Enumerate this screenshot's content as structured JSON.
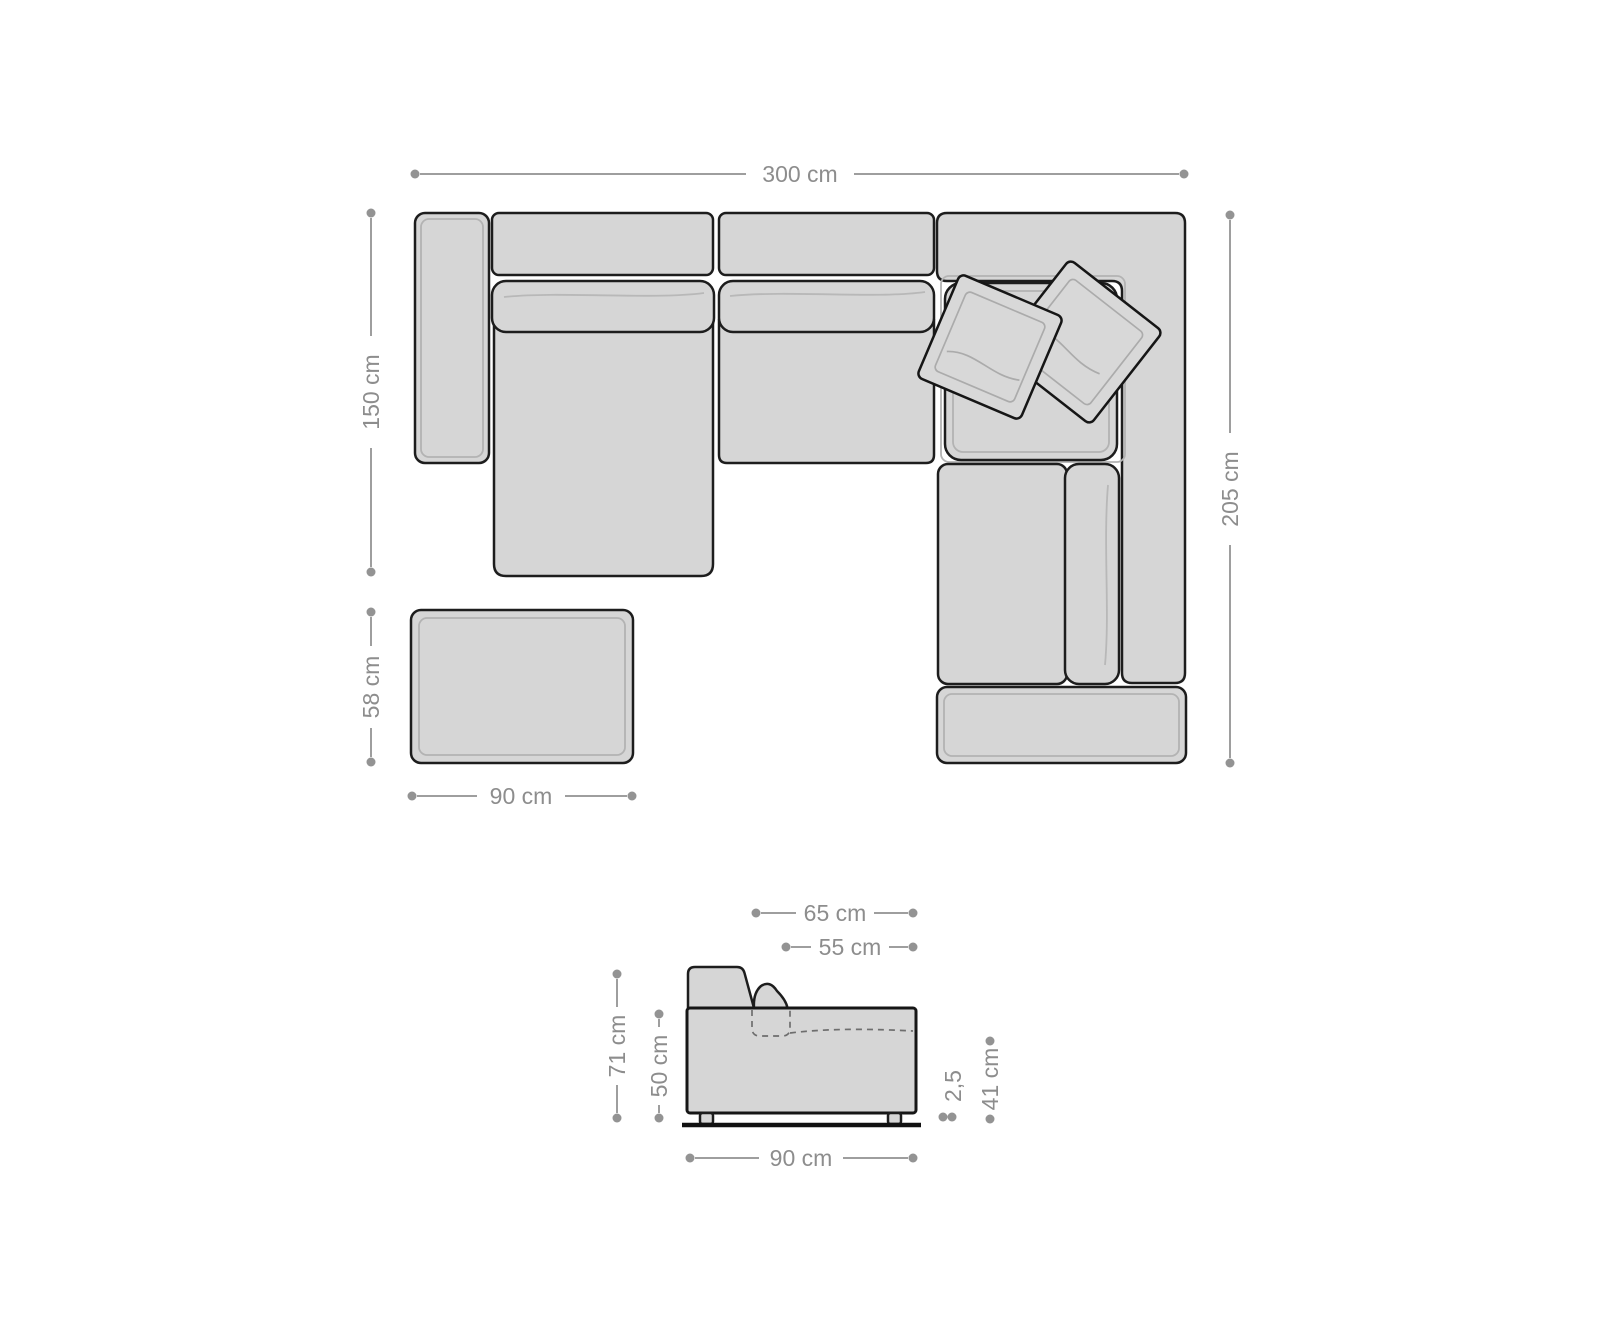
{
  "palette": {
    "background": "#ffffff",
    "furniture_fill": "#d6d6d6",
    "outline": "#1d1d1d",
    "seam_gray": "#b3b3b3",
    "dimension_line": "#9e9e9e",
    "dimension_text": "#8d8d8d"
  },
  "top_view": {
    "width": {
      "label": "300 cm"
    },
    "chaise_depth": {
      "label": "150 cm"
    },
    "total_depth": {
      "label": "205 cm"
    }
  },
  "ottoman": {
    "depth": {
      "label": "58 cm"
    },
    "width": {
      "label": "90 cm"
    }
  },
  "side_view": {
    "backrest_depth": {
      "label": "65 cm"
    },
    "seat_depth": {
      "label": "55 cm"
    },
    "total_height": {
      "label": "71 cm"
    },
    "body_height": {
      "label": "50 cm"
    },
    "leg_height": {
      "label": "2,5"
    },
    "seat_height": {
      "label": "41 cm"
    },
    "width": {
      "label": "90 cm"
    }
  }
}
